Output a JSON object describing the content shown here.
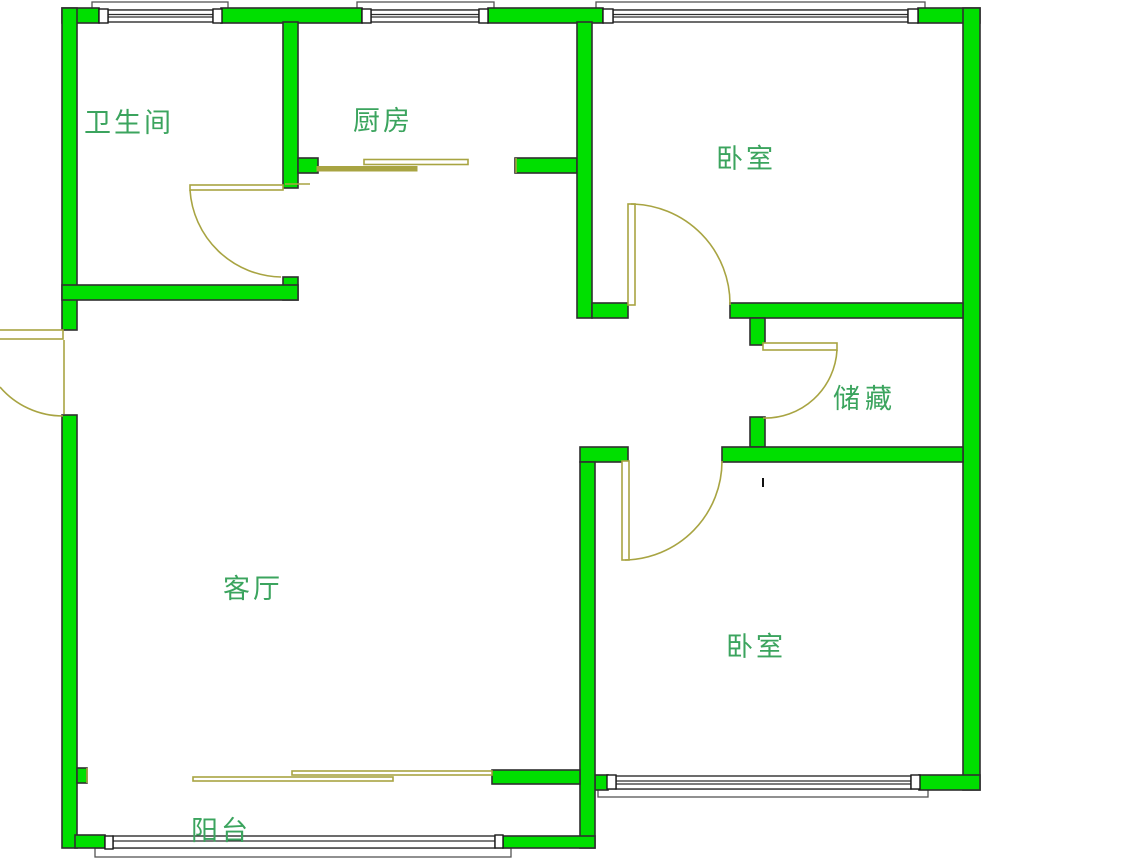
{
  "figure_title": "户型图",
  "colors": {
    "wall_fill": "#00DF00",
    "wall_outline": "#2F2F2F",
    "door": "#A8A442",
    "window_outline": "#2E2E2E",
    "sill_outline": "#555555",
    "label_text": "#3BA45E",
    "background": "#FFFFFF"
  },
  "rooms": [
    {
      "id": "bathroom",
      "label": "卫生间"
    },
    {
      "id": "kitchen",
      "label": "厨房"
    },
    {
      "id": "bedroom-top",
      "label": "卧室"
    },
    {
      "id": "storage",
      "label": "储藏"
    },
    {
      "id": "living-room",
      "label": "客厅"
    },
    {
      "id": "bedroom-bottom",
      "label": "卧室"
    },
    {
      "id": "balcony",
      "label": "阳台"
    }
  ]
}
